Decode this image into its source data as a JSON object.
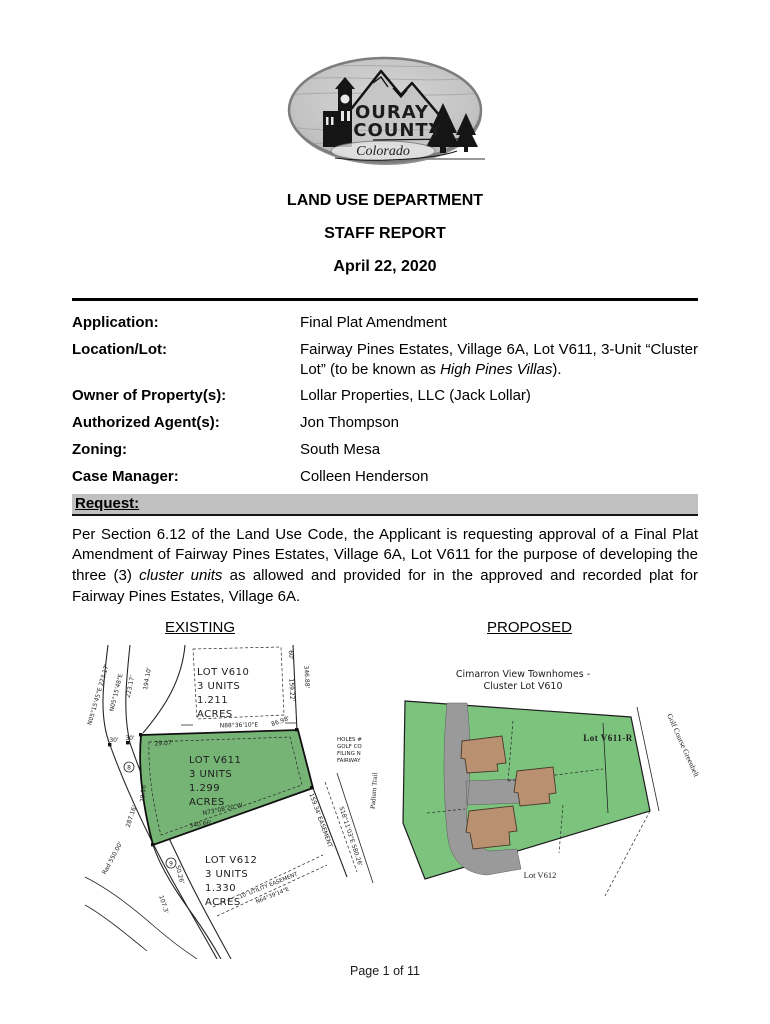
{
  "logo": {
    "name_line1": "OURAY",
    "name_line2": "COUNTY",
    "state": "Colorado"
  },
  "header": {
    "department": "LAND USE DEPARTMENT",
    "report": "STAFF REPORT",
    "date": "April 22, 2020"
  },
  "info": {
    "rows": [
      {
        "label": "Application:",
        "value": "Final Plat Amendment"
      },
      {
        "label": "Location/Lot:",
        "value": {
          "pre": "Fairway Pines Estates, Village 6A, Lot V611, 3-Unit “Cluster Lot” (to be known as ",
          "italic": "High Pines Villas",
          "post": ")."
        }
      },
      {
        "label": "Owner of Property(s):",
        "value": "Lollar Properties, LLC (Jack Lollar)"
      },
      {
        "label": "Authorized Agent(s):",
        "value": "Jon Thompson"
      },
      {
        "label": "Zoning:",
        "value": "South Mesa"
      },
      {
        "label": "Case Manager:",
        "value": "Colleen Henderson"
      }
    ]
  },
  "request": {
    "heading": "Request:",
    "p": {
      "pre": "Per Section 6.12 of the Land Use Code, the Applicant is requesting approval of a Final Plat Amendment of Fairway Pines Estates, Village 6A, Lot V611 for the purpose of developing the three (3) ",
      "italic": "cluster units",
      "post": " as allowed and provided for in the approved and recorded plat for Fairway Pines Estates, Village 6A."
    }
  },
  "existing_map": {
    "heading": "EXISTING",
    "lots": {
      "v610": {
        "name": "LOT V610",
        "units": "3 UNITS",
        "area": "1.211",
        "acres": "ACRES"
      },
      "v611": {
        "name": "LOT V611",
        "units": "3 UNITS",
        "area": "1.299",
        "acres": "ACRES"
      },
      "v612": {
        "name": "LOT V612",
        "units": "3 UNITS",
        "area": "1.330",
        "acres": "ACRES"
      }
    },
    "labels": {
      "bearing_n88": "N88°36'10\"E",
      "d34688": "346.88'",
      "d60": "60'",
      "d15922": "159.22'",
      "d19410": "194.10'",
      "d22317": "223.17'",
      "bearing_n05_long": "N05°15'45\"E 223.17'",
      "bearing_n05": "N05°15'48\"E",
      "d30a": "30'",
      "d30b": "30'",
      "d2907": "29.07'",
      "d34066": "340.66'",
      "bearing_n73": "N73°08'20\"W",
      "d8698": "86.98'",
      "d2816": "28.16'",
      "d28716": "287.16'",
      "rad": "Rad 550.00'",
      "utility_easement": "10' UTILITY EASEMENT",
      "bearing_n64": "N64°39'14\"E",
      "bearing_s18": "S18°11'03\"E 580.26'",
      "easement": "159.34' EASEMENT",
      "d5026": "50.26'",
      "d1073": "107.3'",
      "circle8": "8",
      "circle9": "9",
      "note_l1": "HOLES #",
      "note_l2": "GOLF CO",
      "note_l3": "FILING N",
      "note_l4": "FAIRWAY"
    }
  },
  "proposed_map": {
    "heading": "PROPOSED",
    "title1": "Cimarron View Townhomes -",
    "title2": "Cluster Lot V610",
    "lot_main": "Lot V611-R",
    "lot_below": "Lot V612",
    "greenbelt": "Golf Course Greenbelt",
    "street": "Padium Trail"
  },
  "footer": {
    "page": "Page 1 of 11"
  },
  "colors": {
    "lot_green": "#76b476",
    "proposed_green": "#7cc47e",
    "building_tan": "#b99070",
    "driveway_gray": "#9a9a9a",
    "request_bar_gray": "#c0c0c0",
    "logo_gray": "#bdbdbd"
  }
}
